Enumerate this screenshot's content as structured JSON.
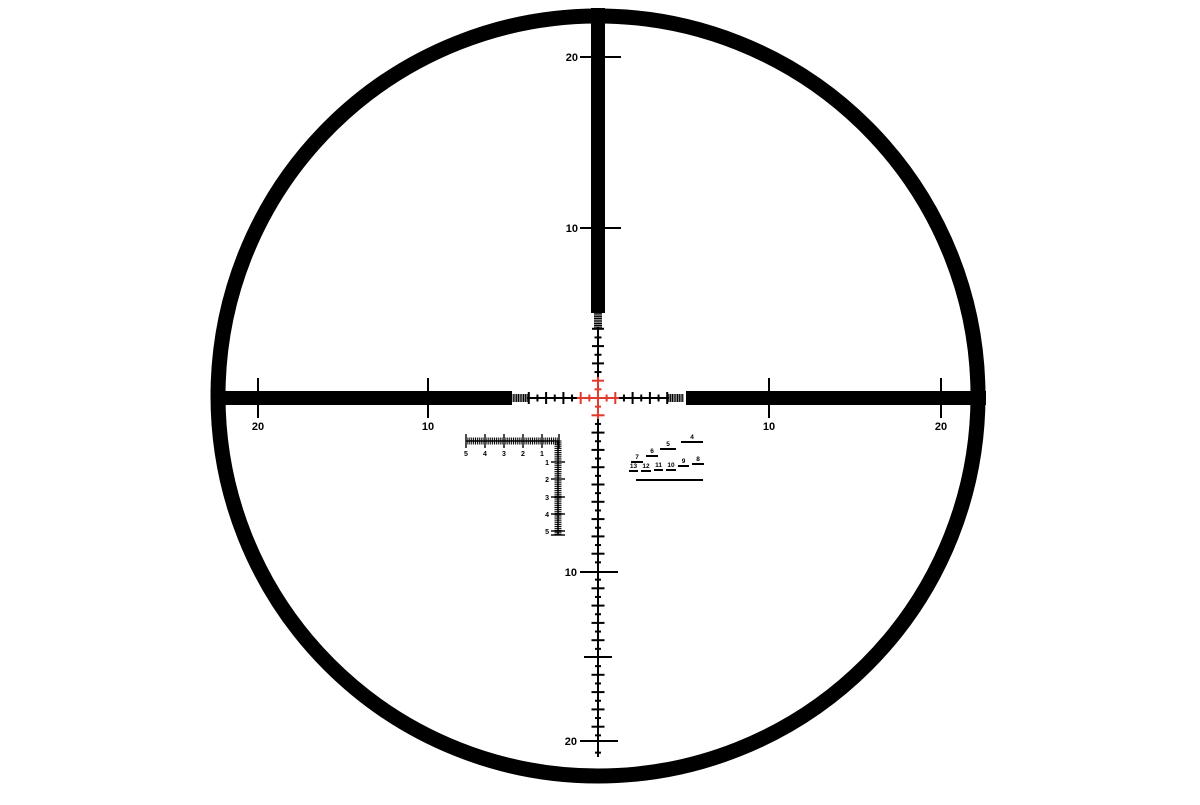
{
  "meta": {
    "title": "Telescopic sight mil-based reticle with rapid rangefinder",
    "colors": {
      "background": "#ffffff",
      "ink": "#000000",
      "red": "#e23b2e"
    }
  },
  "reticle": {
    "center": {
      "x": 598,
      "y": 398
    },
    "mil_px": 17.3,
    "ring": {
      "cx": 598,
      "cy": 396,
      "r": 380,
      "stroke_width": 15
    },
    "posts": {
      "top": {
        "x": 591,
        "y": 8,
        "w": 14,
        "h": 305
      },
      "left": {
        "x": 211,
        "y": 391,
        "w": 301,
        "h": 14
      },
      "right": {
        "x": 686,
        "y": 391,
        "w": 300,
        "h": 14
      }
    },
    "post_marks": {
      "top": [
        {
          "label": "20",
          "y": 57
        },
        {
          "label": "10",
          "y": 228
        }
      ],
      "left": [
        {
          "label": "20",
          "x": 258
        },
        {
          "label": "10",
          "x": 428
        }
      ],
      "right": [
        {
          "label": "10",
          "x": 769
        },
        {
          "label": "20",
          "x": 941
        }
      ],
      "bottom": [
        {
          "label": "10",
          "y": 572
        },
        {
          "label": "",
          "y": 657
        },
        {
          "label": "20",
          "y": 741
        }
      ]
    },
    "fine": {
      "arm_mils": 4.0,
      "tick_step_mil": 0.5,
      "whole_tick_len": 12,
      "half_tick_len": 7,
      "bottom_whole_tick_len": 13,
      "bottom_half_tick_len": 6,
      "comb_from_mil": 4.1,
      "comb_to_mil": 4.9,
      "comb_step_mil": 0.1,
      "comb_tooth_len": 8,
      "red_extent_mil": 1.22,
      "bottom_end_y": 757,
      "bottom_skip_whole": [
        10,
        15,
        20
      ]
    }
  },
  "l_scale": {
    "horizontal": {
      "y": 441,
      "x_start": 466,
      "x_end": 559,
      "tooth_step": 1.9,
      "tooth_len": 7,
      "major_len": 14,
      "labels": [
        {
          "text": "5",
          "x": 466
        },
        {
          "text": "4",
          "x": 485
        },
        {
          "text": "3",
          "x": 504
        },
        {
          "text": "2",
          "x": 523
        },
        {
          "text": "1",
          "x": 542
        }
      ],
      "label_y": 456
    },
    "vertical": {
      "x": 558,
      "y_start": 441,
      "y_end": 535,
      "tooth_step": 1.9,
      "tooth_len": 7,
      "major_len": 14,
      "labels": [
        {
          "text": "1",
          "y": 462
        },
        {
          "text": "2",
          "y": 479
        },
        {
          "text": "3",
          "y": 497
        },
        {
          "text": "4",
          "y": 514
        },
        {
          "text": "5",
          "y": 531
        }
      ],
      "label_x": 549
    }
  },
  "rangefinder": {
    "baseline": {
      "x1": 636,
      "x2": 703,
      "y": 480
    },
    "steps": [
      {
        "label": "4",
        "x1": 681,
        "x2": 703,
        "y": 442
      },
      {
        "label": "5",
        "x1": 660,
        "x2": 676,
        "y": 449
      },
      {
        "label": "6",
        "x1": 646,
        "x2": 658,
        "y": 456
      },
      {
        "label": "7",
        "x1": 631,
        "x2": 643,
        "y": 462
      },
      {
        "label": "8",
        "x1": 692,
        "x2": 704,
        "y": 464
      },
      {
        "label": "9",
        "x1": 678,
        "x2": 689,
        "y": 466
      },
      {
        "label": "10",
        "x1": 666,
        "x2": 676,
        "y": 470
      },
      {
        "label": "11",
        "x1": 654,
        "x2": 663,
        "y": 470
      },
      {
        "label": "12",
        "x1": 641,
        "x2": 651,
        "y": 471
      },
      {
        "label": "13",
        "x1": 629,
        "x2": 638,
        "y": 471
      }
    ]
  }
}
